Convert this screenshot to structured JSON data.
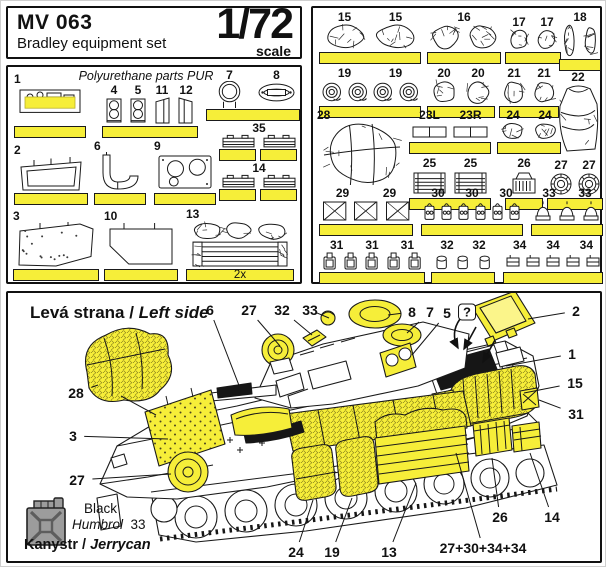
{
  "colors": {
    "highlight": "#f6ee39",
    "line": "#1a1a1a",
    "legend_gray": "#9c9c9c"
  },
  "header": {
    "title": "MV 063",
    "subtitle": "Bradley equipment set",
    "scale_value": "1/72",
    "scale_word": "scale"
  },
  "left_panel": {
    "note": "Polyurethane parts PUR",
    "groups": [
      {
        "labels": [
          "1"
        ],
        "kind": "rack",
        "x": 6,
        "y": 5,
        "w": 72,
        "h": 66,
        "base": "single",
        "labelPos": "tl"
      },
      {
        "labels": [
          "4",
          "5",
          "11",
          "12"
        ],
        "kinds": [
          "tower",
          "tower",
          "wedgeL",
          "wedgeR"
        ],
        "x": 94,
        "y": 16,
        "w": 96,
        "h": 55,
        "base": "single",
        "labelPos": "top"
      },
      {
        "labels": [
          "7",
          "8"
        ],
        "kinds": [
          "ring",
          "oval8"
        ],
        "x": 198,
        "y": 1,
        "w": 94,
        "h": 53,
        "base": "single",
        "labelPos": "top"
      },
      {
        "labels": [
          "35"
        ],
        "kind": "smallbox",
        "count": 2,
        "x": 210,
        "y": 54,
        "w": 82,
        "h": 40,
        "base": "split",
        "labelPos": "top"
      },
      {
        "labels": [
          "14"
        ],
        "kind": "smallbox",
        "count": 2,
        "x": 210,
        "y": 94,
        "w": 82,
        "h": 40,
        "base": "split",
        "labelPos": "top"
      },
      {
        "labels": [
          "2"
        ],
        "kind": "openbox",
        "x": 6,
        "y": 76,
        "w": 74,
        "h": 62,
        "base": "single",
        "labelPos": "tl"
      },
      {
        "labels": [
          "6"
        ],
        "kind": "hook",
        "x": 86,
        "y": 72,
        "w": 52,
        "h": 66,
        "base": "single",
        "labelPos": "tl"
      },
      {
        "labels": [
          "9"
        ],
        "kind": "plate2",
        "x": 146,
        "y": 72,
        "w": 62,
        "h": 66,
        "base": "single",
        "labelPos": "tl"
      },
      {
        "labels": [
          "3"
        ],
        "kind": "mat",
        "x": 5,
        "y": 142,
        "w": 86,
        "h": 72,
        "base": "single",
        "labelPos": "tl"
      },
      {
        "labels": [
          "10"
        ],
        "kind": "pent",
        "x": 96,
        "y": 142,
        "w": 74,
        "h": 72,
        "base": "single",
        "labelPos": "tl"
      },
      {
        "labels": [
          "13"
        ],
        "kind": "gearstack",
        "x": 178,
        "y": 140,
        "w": 108,
        "h": 74,
        "base": "single",
        "baseText": "2x",
        "labelPos": "tl"
      }
    ]
  },
  "right_panel": {
    "groups": [
      {
        "labels": [
          "15",
          "15"
        ],
        "kind": "bag",
        "x": 6,
        "y": 2,
        "w": 102,
        "h": 54,
        "base": "single",
        "labelPos": "top"
      },
      {
        "labels": [
          "16"
        ],
        "kind": "bag",
        "count": 2,
        "x": 114,
        "y": 2,
        "w": 74,
        "h": 54,
        "base": "single",
        "labelPos": "top"
      },
      {
        "labels": [
          "17",
          "17"
        ],
        "kind": "smallbag",
        "x": 192,
        "y": 7,
        "w": 56,
        "h": 49,
        "base": "single",
        "labelPos": "top"
      },
      {
        "labels": [
          "18"
        ],
        "kind": "tallbag",
        "count": 2,
        "x": 246,
        "y": 2,
        "w": 42,
        "h": 61,
        "base": "single",
        "labelPos": "top"
      },
      {
        "labels": [
          "19",
          "19"
        ],
        "kind": "coil",
        "count": 4,
        "x": 6,
        "y": 58,
        "w": 102,
        "h": 52,
        "base": "single",
        "labelPos": "top"
      },
      {
        "labels": [
          "20",
          "20"
        ],
        "kind": "smallbag",
        "x": 114,
        "y": 58,
        "w": 68,
        "h": 52,
        "base": "single",
        "labelPos": "top"
      },
      {
        "labels": [
          "21",
          "21"
        ],
        "kind": "smallbag",
        "x": 186,
        "y": 58,
        "w": 60,
        "h": 52,
        "base": "single",
        "labelPos": "top"
      },
      {
        "labels": [
          "22"
        ],
        "kind": "sack",
        "x": 240,
        "y": 62,
        "w": 50,
        "h": 84,
        "base": "none",
        "labelPos": "top"
      },
      {
        "labels": [
          "28"
        ],
        "kind": "bundle",
        "x": 4,
        "y": 100,
        "w": 90,
        "h": 82,
        "base": "none",
        "labelPos": "tl"
      },
      {
        "labels": [
          "23L",
          "23R"
        ],
        "kinds": [
          "box",
          "box"
        ],
        "x": 96,
        "y": 100,
        "w": 82,
        "h": 46,
        "base": "single",
        "labelPos": "top"
      },
      {
        "labels": [
          "24",
          "24"
        ],
        "kind": "smallbag",
        "x": 184,
        "y": 100,
        "w": 64,
        "h": 46,
        "base": "single",
        "labelPos": "top"
      },
      {
        "labels": [
          "25",
          "25"
        ],
        "kind": "crate",
        "x": 96,
        "y": 148,
        "w": 82,
        "h": 54,
        "base": "single",
        "labelPos": "top"
      },
      {
        "labels": [
          "26"
        ],
        "kind": "canister",
        "x": 192,
        "y": 148,
        "w": 38,
        "h": 54,
        "base": "single",
        "labelPos": "top"
      },
      {
        "labels": [
          "27",
          "27"
        ],
        "kind": "wheel",
        "x": 234,
        "y": 150,
        "w": 56,
        "h": 52,
        "base": "single",
        "labelPos": "top"
      },
      {
        "labels": [
          "29",
          "29"
        ],
        "kind": "xpanel",
        "count": 3,
        "x": 6,
        "y": 178,
        "w": 94,
        "h": 50,
        "base": "single",
        "labelPos": "top"
      },
      {
        "labels": [
          "30",
          "30",
          "30"
        ],
        "kind": "smallkit",
        "count": 6,
        "x": 108,
        "y": 178,
        "w": 102,
        "h": 50,
        "base": "single",
        "labelPos": "top"
      },
      {
        "labels": [
          "33",
          "33"
        ],
        "kind": "dome",
        "count": 3,
        "x": 218,
        "y": 178,
        "w": 72,
        "h": 50,
        "base": "single",
        "labelPos": "top"
      },
      {
        "labels": [
          "31",
          "31",
          "31"
        ],
        "kind": "jerrycan",
        "count": 5,
        "x": 6,
        "y": 230,
        "w": 106,
        "h": 46,
        "base": "single",
        "labelPos": "top"
      },
      {
        "labels": [
          "32",
          "32"
        ],
        "kind": "tiny",
        "count": 3,
        "x": 118,
        "y": 230,
        "w": 64,
        "h": 46,
        "base": "single",
        "labelPos": "top"
      },
      {
        "labels": [
          "34",
          "34",
          "34"
        ],
        "kind": "flat",
        "count": 5,
        "x": 190,
        "y": 230,
        "w": 100,
        "h": 46,
        "base": "single",
        "labelPos": "top"
      }
    ]
  },
  "bottom_panel": {
    "title_cs": "Levá strana / ",
    "title_en": "Left side",
    "legend": {
      "color_name": "Black",
      "paint_brand": "Humbrol",
      "paint_code": "33",
      "item_cs": "Kanystr / ",
      "item_en": "Jerrycan"
    },
    "callouts": [
      {
        "t": "6",
        "x": 202,
        "y": 17,
        "tx": 232,
        "ty": 95
      },
      {
        "t": "27",
        "x": 241,
        "y": 17,
        "tx": 272,
        "ty": 53
      },
      {
        "t": "32",
        "x": 274,
        "y": 17,
        "tx": 304,
        "ty": 42
      },
      {
        "t": "33",
        "x": 302,
        "y": 17,
        "tx": 321,
        "ty": 25
      },
      {
        "t": "8",
        "x": 404,
        "y": 19,
        "tx": 380,
        "ty": 22
      },
      {
        "t": "7",
        "x": 422,
        "y": 19,
        "tx": 399,
        "ty": 40
      },
      {
        "t": "5",
        "x": 439,
        "y": 20,
        "tx": 404,
        "ty": 62
      },
      {
        "t": "?",
        "x": 459,
        "y": 19,
        "boxed": true
      },
      {
        "t": "2",
        "x": 568,
        "y": 18,
        "tx": 520,
        "ty": 26
      },
      {
        "t": "1",
        "x": 564,
        "y": 61,
        "tx": 498,
        "ty": 73
      },
      {
        "t": "15",
        "x": 567,
        "y": 90,
        "tx": 516,
        "ty": 100
      },
      {
        "t": "31",
        "x": 568,
        "y": 121,
        "tx": 531,
        "ty": 107
      },
      {
        "t": "28",
        "x": 68,
        "y": 100,
        "tx": 90,
        "ty": 92
      },
      {
        "t": "3",
        "x": 65,
        "y": 143,
        "tx": 160,
        "ty": 146
      },
      {
        "t": "27",
        "x": 69,
        "y": 187,
        "tx": 163,
        "ty": 181
      },
      {
        "t": "24",
        "x": 288,
        "y": 259,
        "tx": 305,
        "ty": 207
      },
      {
        "t": "19",
        "x": 324,
        "y": 259,
        "tx": 344,
        "ty": 205
      },
      {
        "t": "13",
        "x": 381,
        "y": 259,
        "tx": 408,
        "ty": 190
      },
      {
        "t": "27+30+34+34",
        "x": 475,
        "y": 255,
        "tx": 448,
        "ty": 160
      },
      {
        "t": "26",
        "x": 492,
        "y": 224,
        "tx": 484,
        "ty": 165
      },
      {
        "t": "14",
        "x": 544,
        "y": 224,
        "tx": 522,
        "ty": 160
      }
    ]
  }
}
